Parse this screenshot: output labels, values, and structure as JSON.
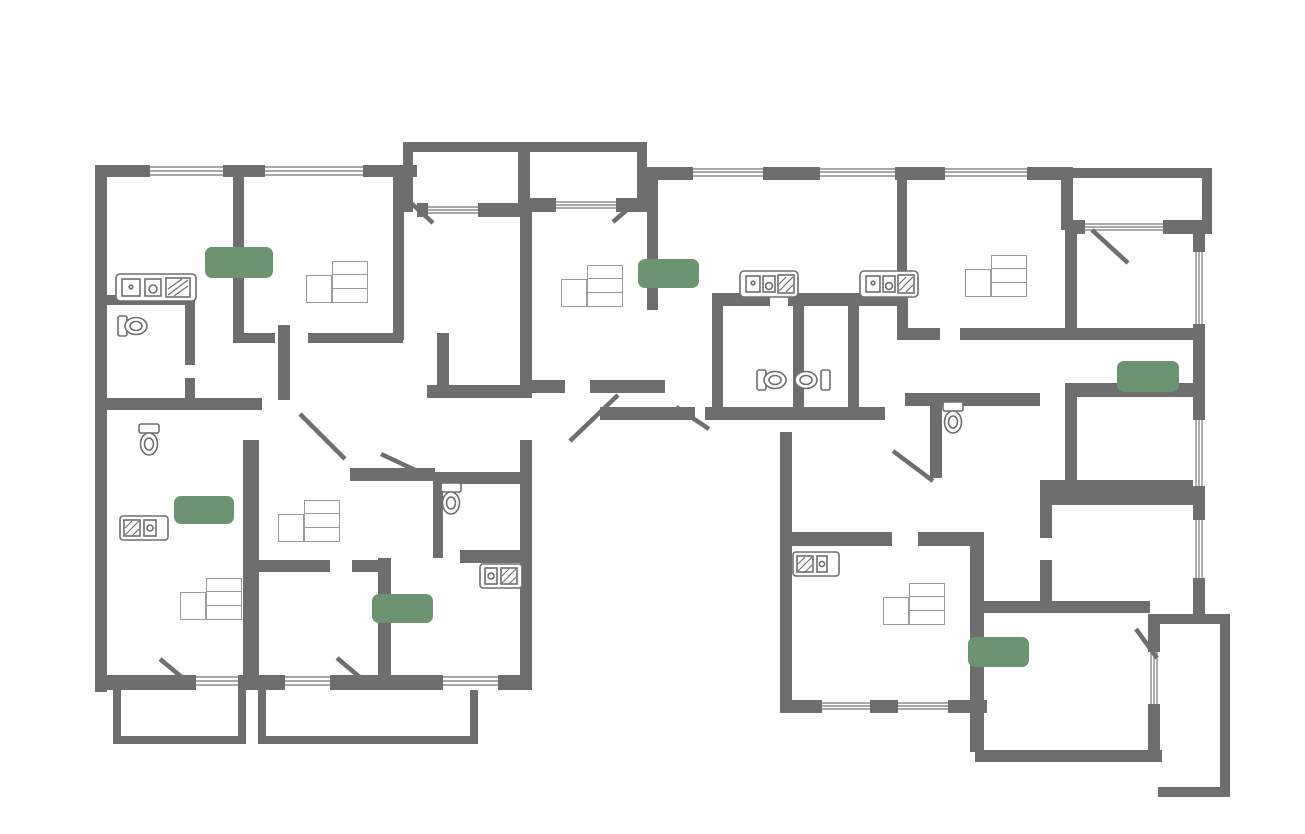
{
  "header": {
    "line1": "Многоэтажный жилой дом № 2 со встроенными нежилыми помещениями, автостоянкой",
    "line2": "и инженерным обеспечением по адресу: г. Красноярск, ул.Норильская",
    "line2_bold": "Секция №4",
    "floor": "этаж 8"
  },
  "watermark": {
    "line1": "аревара",
    "line2": "НЕДВИЖИМОСТЬ"
  },
  "colors": {
    "wall": "#6e6e6e",
    "accent_green": "#55915a",
    "badge_green": "#6d9470",
    "text_gray": "#6e6e6e"
  },
  "plan": {
    "badges": {
      "a553": "55,3",
      "a354": "35,4",
      "a640": "64,0",
      "a242": "24,2",
      "a353": "35,3",
      "a645": "64,5"
    },
    "tables": {
      "t553": {
        "type": "2К",
        "r1": "30,2",
        "r2": "53,4",
        "r3": "55,3"
      },
      "t354": {
        "type": "1К",
        "r1": "14,5",
        "r2": "33,4",
        "r3": "35,4"
      },
      "t640": {
        "type": "3К",
        "r1": "39,5",
        "r2": "61,7",
        "r3": "64,0"
      },
      "t353": {
        "type": "1К",
        "r1": "15,6",
        "r2": "33,6",
        "r3": "35,3"
      },
      "t242": {
        "type": "1К",
        "r1": "9,7",
        "r2": "22,8",
        "r3": "24,2"
      },
      "t645": {
        "type": "2К",
        "r1": "27,2",
        "r2": "62,2",
        "r3": "64,5"
      }
    },
    "rooms": {
      "k96": {
        "num": "9,6",
        "name": "кухня"
      },
      "liv163": {
        "num": "16,3",
        "name": "жилая комната"
      },
      "log37": {
        "num": "3,7/1,9",
        "name": "лоджия"
      },
      "log40": {
        "num": "4,0/2,0",
        "name": "лоджия"
      },
      "bed139": {
        "num": "13,9",
        "name": "спальня"
      },
      "bath40": {
        "num": "4,0"
      },
      "cor30": {
        "num": "3,0",
        "name": "коридор"
      },
      "hall66": {
        "num": "6,6",
        "name": "прихожая"
      },
      "liv145": {
        "num": "14,5",
        "name": "жилая комната"
      },
      "hall46": {
        "num": "4,6",
        "name": "прихожая"
      },
      "kit106": {
        "num": "10,6",
        "name": "кухня"
      },
      "bath37a": {
        "num": "3,7"
      },
      "bath37b": {
        "num": "3,7"
      },
      "kit88": {
        "num": "8,8",
        "name": "кухня"
      },
      "liv160": {
        "num": "16,0",
        "name": "жилая комната"
      },
      "log46": {
        "num": "4,6/2,3",
        "name": "лоджия"
      },
      "bed121": {
        "num": "12,1",
        "name": "спальня"
      },
      "hall35": {
        "num": "3,5",
        "name": "прихожая"
      },
      "cor62": {
        "num": "6,2",
        "name": "коридор"
      },
      "bed114": {
        "num": "11,4",
        "name": "спальня"
      },
      "bath41a": {
        "num": "4,1"
      },
      "hall33": {
        "num": "3,3",
        "name": "прихожая"
      },
      "bath38": {
        "num": "3,8"
      },
      "niche60": {
        "num": "6,0",
        "name": "кухня-ниша"
      },
      "liv97": {
        "num": "9,7",
        "name": "жилая комната"
      },
      "bal46": {
        "num": "4,6/1,4",
        "name": "балкон"
      },
      "hall34": {
        "num": "3,4",
        "name": "прихожая"
      },
      "bath41b": {
        "num": "4,1"
      },
      "liv156": {
        "num": "15,6",
        "name": "жилая комната"
      },
      "kit105": {
        "num": "10,5",
        "name": "кухня"
      },
      "bal57": {
        "num": "5,7/1,7",
        "name": "балкон"
      },
      "hall72": {
        "num": "7,2",
        "name": "прихожая"
      },
      "cor34": {
        "num": "3,4",
        "name": "коридор"
      },
      "kit203": {
        "num": "20,3",
        "name": "кухня-столовая"
      },
      "liv162": {
        "num": "16,2",
        "name": "жилая комната"
      },
      "bed110": {
        "num": "11,0",
        "name": "спальня"
      },
      "log45": {
        "num": "4,5/2,3",
        "name": "лоджия"
      }
    }
  }
}
